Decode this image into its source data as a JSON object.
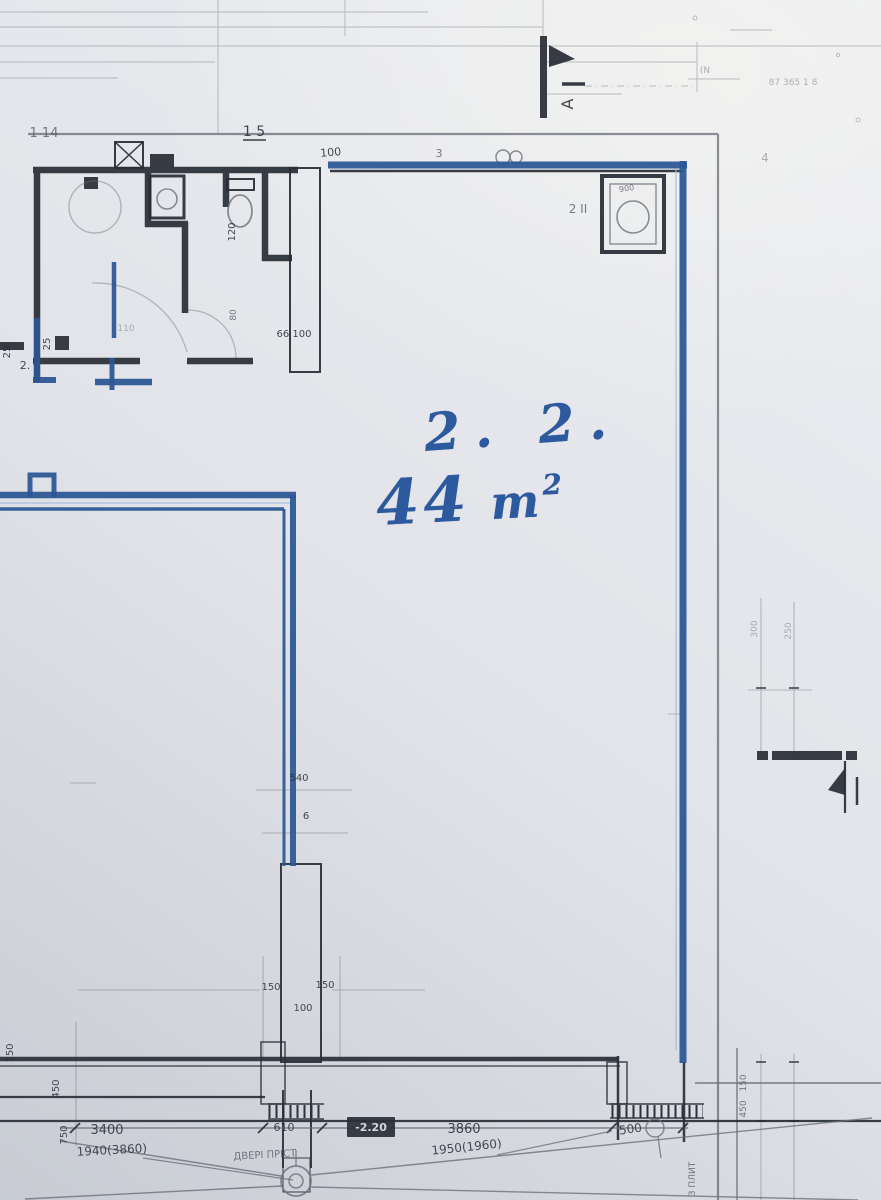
{
  "annotations": {
    "room_number": "2. 2.",
    "area_value": "44",
    "area_unit": " m",
    "area_sup": "2"
  },
  "colors": {
    "paper": "#e3e5ea",
    "paper_light": "#eceef2",
    "paper_shade": "#d6d9e0",
    "pencil": "#6b7078",
    "ink": "#272c35",
    "marker_blue": "#2a5694",
    "marker_blue_light": "#9fbede",
    "handwriting_blue": "#2d5a9f"
  },
  "labels": [
    {
      "name": "grid-mark-top-left",
      "text": "1 14",
      "x": 44,
      "y": 137,
      "rot": 0,
      "size": 13,
      "cls": "pencil"
    },
    {
      "name": "grid-mark-top",
      "text": "1 5",
      "x": 254,
      "y": 136,
      "rot": 0,
      "size": 14,
      "cls": "ink"
    },
    {
      "name": "dim-100-top",
      "text": "100",
      "x": 331,
      "y": 156,
      "rot": -5,
      "size": 11,
      "cls": "ink"
    },
    {
      "name": "tick-3-top",
      "text": "3",
      "x": 439,
      "y": 157,
      "rot": 0,
      "size": 11,
      "cls": "pencil"
    },
    {
      "name": "shaft-room-label",
      "text": "2 II",
      "x": 578,
      "y": 213,
      "rot": 0,
      "size": 12,
      "cls": "pencil"
    },
    {
      "name": "dim-900-shaft",
      "text": "900",
      "x": 627,
      "y": 191,
      "rot": -8,
      "size": 8,
      "cls": "pencil"
    },
    {
      "name": "ref-4-top-right",
      "text": "4",
      "x": 765,
      "y": 162,
      "rot": 0,
      "size": 12,
      "cls": "pencil-faint"
    },
    {
      "name": "doc-number-top-right",
      "text": "87 365 1 8",
      "x": 793,
      "y": 85,
      "rot": 0,
      "size": 9,
      "cls": "pencil-faint"
    },
    {
      "name": "note-n-top-right",
      "text": "(N",
      "x": 705,
      "y": 73,
      "rot": 0,
      "size": 9,
      "cls": "pencil-faint"
    },
    {
      "name": "section-letter-a",
      "text": "A",
      "x": 573,
      "y": 104,
      "rot": -90,
      "size": 16,
      "cls": "ink"
    },
    {
      "name": "dim-25-wall",
      "text": "25",
      "x": 50,
      "y": 344,
      "rot": -90,
      "size": 10,
      "cls": "ink"
    },
    {
      "name": "dim-25-edge",
      "text": "25",
      "x": 10,
      "y": 352,
      "rot": -90,
      "size": 10,
      "cls": "ink"
    },
    {
      "name": "dim-110-bath",
      "text": "110",
      "x": 126,
      "y": 331,
      "rot": 0,
      "size": 9,
      "cls": "pencil-faint"
    },
    {
      "name": "dim-120-wc",
      "text": "120",
      "x": 235,
      "y": 232,
      "rot": -90,
      "size": 10,
      "cls": "ink"
    },
    {
      "name": "dim-80-wc",
      "text": "80",
      "x": 236,
      "y": 315,
      "rot": -90,
      "size": 9,
      "cls": "pencil"
    },
    {
      "name": "dim-66-100",
      "text": "66 100",
      "x": 294,
      "y": 337,
      "rot": 0,
      "size": 10,
      "cls": "ink"
    },
    {
      "name": "label-2-bath",
      "text": "2.",
      "x": 25,
      "y": 369,
      "rot": 0,
      "size": 11,
      "cls": "ink"
    },
    {
      "name": "dim-540-wall",
      "text": "540",
      "x": 299,
      "y": 781,
      "rot": 0,
      "size": 10,
      "cls": "ink"
    },
    {
      "name": "dim-6-wall",
      "text": "6",
      "x": 306,
      "y": 819,
      "rot": 0,
      "size": 10,
      "cls": "ink"
    },
    {
      "name": "dim-150-column-left",
      "text": "150",
      "x": 271,
      "y": 990,
      "rot": 0,
      "size": 10,
      "cls": "ink"
    },
    {
      "name": "dim-150-column-right",
      "text": "150",
      "x": 325,
      "y": 988,
      "rot": 0,
      "size": 10,
      "cls": "ink"
    },
    {
      "name": "dim-100-column",
      "text": "100",
      "x": 303,
      "y": 1011,
      "rot": 0,
      "size": 10,
      "cls": "ink"
    },
    {
      "name": "dim-150-bottom-left",
      "text": "150",
      "x": 13,
      "y": 1053,
      "rot": -90,
      "size": 10,
      "cls": "ink"
    },
    {
      "name": "dim-450-bottom-left",
      "text": "450",
      "x": 59,
      "y": 1089,
      "rot": -90,
      "size": 10,
      "cls": "ink"
    },
    {
      "name": "dim-750-bottom-left",
      "text": "750",
      "x": 67,
      "y": 1135,
      "rot": -90,
      "size": 10,
      "cls": "ink"
    },
    {
      "name": "dim-3400",
      "text": "3400",
      "x": 107,
      "y": 1134,
      "rot": 0,
      "size": 13,
      "cls": "ink"
    },
    {
      "name": "dim-610",
      "text": "610",
      "x": 284,
      "y": 1131,
      "rot": 0,
      "size": 11,
      "cls": "ink"
    },
    {
      "name": "elevation-mark",
      "text": "-2.20",
      "x": 371,
      "y": 1131,
      "rot": 0,
      "size": 11,
      "cls": "boxed"
    },
    {
      "name": "dim-3860",
      "text": "3860",
      "x": 464,
      "y": 1133,
      "rot": 0,
      "size": 13,
      "cls": "ink"
    },
    {
      "name": "dim-500",
      "text": "500",
      "x": 631,
      "y": 1133,
      "rot": -8,
      "size": 12,
      "cls": "ink"
    },
    {
      "name": "dim-total-left",
      "text": "1940(3860)",
      "x": 112,
      "y": 1154,
      "rot": -3,
      "size": 12,
      "cls": "ink"
    },
    {
      "name": "dim-total-right",
      "text": "1950(1960)",
      "x": 467,
      "y": 1151,
      "rot": -6,
      "size": 12,
      "cls": "ink"
    },
    {
      "name": "note-doors",
      "text": "ДВЕРІ ПРІСТ",
      "x": 265,
      "y": 1158,
      "rot": -3,
      "size": 10,
      "cls": "pencil"
    },
    {
      "name": "dim-150-bottom-right",
      "text": "150",
      "x": 746,
      "y": 1083,
      "rot": -90,
      "size": 9,
      "cls": "pencil"
    },
    {
      "name": "dim-450-bottom-right",
      "text": "450",
      "x": 746,
      "y": 1109,
      "rot": -90,
      "size": 9,
      "cls": "pencil"
    },
    {
      "name": "dim-right-mid-1",
      "text": "300",
      "x": 757,
      "y": 629,
      "rot": -90,
      "size": 9,
      "cls": "pencil-faint"
    },
    {
      "name": "dim-right-mid-2",
      "text": "250",
      "x": 791,
      "y": 631,
      "rot": -90,
      "size": 9,
      "cls": "pencil-faint"
    },
    {
      "name": "note-vertical-bottom-right",
      "text": "З ПЛИТ",
      "x": 695,
      "y": 1179,
      "rot": -90,
      "size": 9,
      "cls": "pencil"
    }
  ]
}
